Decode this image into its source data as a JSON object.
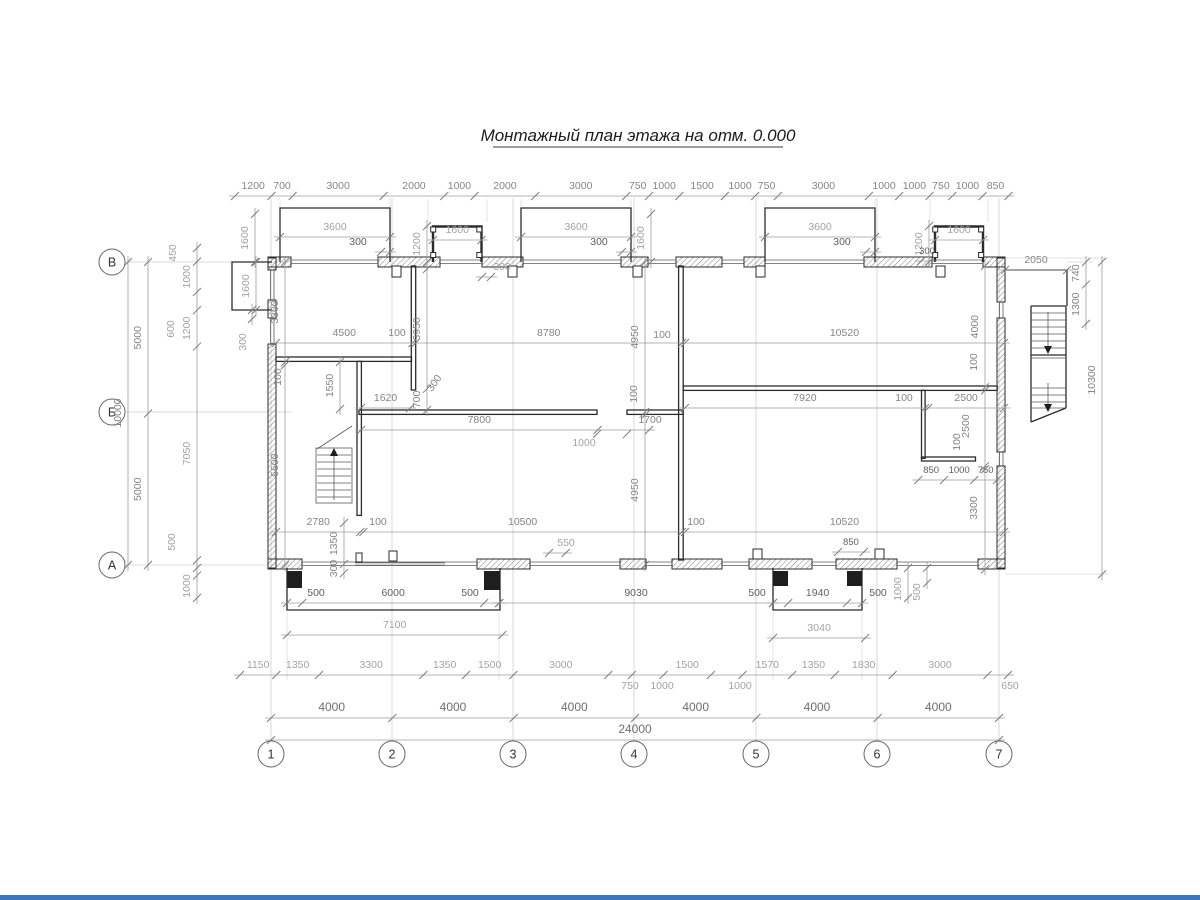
{
  "title": "Монтажный план этажа на отм. 0.000",
  "axes": {
    "cols": [
      "1",
      "2",
      "3",
      "4",
      "5",
      "6",
      "7"
    ],
    "rows": [
      "В",
      "Б",
      "А"
    ]
  },
  "chains": {
    "top": [
      "1200",
      "700",
      "3000",
      "2000",
      "1000",
      "2000",
      "3000",
      "750",
      "1000",
      "1500",
      "1000",
      "750",
      "3000",
      "1000",
      "1000",
      "750",
      "1000",
      "850"
    ],
    "bottom_detail": [
      "1150",
      "1350",
      "3300",
      "1350",
      "1500",
      "3000",
      "750",
      "1000",
      "1500",
      "1000",
      "1570",
      "1350",
      "1830",
      "3000",
      "650"
    ],
    "bottom_axes": [
      "4000",
      "4000",
      "4000",
      "4000",
      "4000",
      "4000"
    ],
    "bottom_total": [
      "24000"
    ],
    "left_inner": [
      "5000",
      "5000"
    ],
    "left_total": [
      "10000"
    ],
    "left_detail": [
      "450",
      "1000",
      "600",
      "1200",
      "7050",
      "500"
    ],
    "left_wall": [
      "3300",
      "100",
      "6600"
    ],
    "upper_mid": [
      "4500",
      "100",
      "8780",
      "100",
      "10520"
    ],
    "right_mid": [
      "7920",
      "100",
      "2500"
    ],
    "low": [
      "2780",
      "100",
      "10500",
      "100",
      "10520"
    ],
    "right_small": [
      "850",
      "1000",
      "750"
    ],
    "porch1": [
      "500",
      "6000",
      "500"
    ],
    "porch1_total": [
      "7100"
    ],
    "porch_span": [
      "9030"
    ],
    "porch2": [
      "500",
      "1940",
      "500"
    ],
    "porch2_total": [
      "3040"
    ],
    "stair_top": [
      "2050"
    ],
    "stair_v": [
      "740",
      "1300"
    ],
    "right_total": [
      "10300"
    ],
    "right_inner": [
      "4000",
      "100",
      "2500",
      "100",
      "3300"
    ],
    "mid_v": [
      "4950",
      "100",
      "4950"
    ],
    "left_v": [
      "3950",
      "700"
    ],
    "c1550": [
      "1550"
    ],
    "c1620": [
      "1620"
    ],
    "c7800": [
      "7800",
      "1700"
    ],
    "c550": [
      "550"
    ],
    "c850": [
      "850"
    ],
    "c1350": [
      "1350",
      "300"
    ],
    "bay1": [
      "3600"
    ],
    "bay2": [
      "3600"
    ],
    "bay3": [
      "3600"
    ],
    "bay1p": [
      "300"
    ],
    "bay2p": [
      "300"
    ],
    "bay3p": [
      "300"
    ],
    "sb1": [
      "1600"
    ],
    "sb2": [
      "1600"
    ],
    "sb1d": [
      "1200"
    ],
    "sb2d": [
      "1200"
    ],
    "win_left": [
      "1600"
    ],
    "win_mid": [
      "1600"
    ],
    "top300": [
      "300"
    ],
    "top300r": [
      "300"
    ],
    "bump": [
      "1600"
    ],
    "bump300": [
      "300"
    ],
    "porch2_v1000": [
      "1000"
    ],
    "porch2_v500": [
      "500"
    ],
    "porch1_v1000": [
      "1000"
    ],
    "door1000": [
      "1000"
    ],
    "diag300": [
      "300"
    ]
  }
}
